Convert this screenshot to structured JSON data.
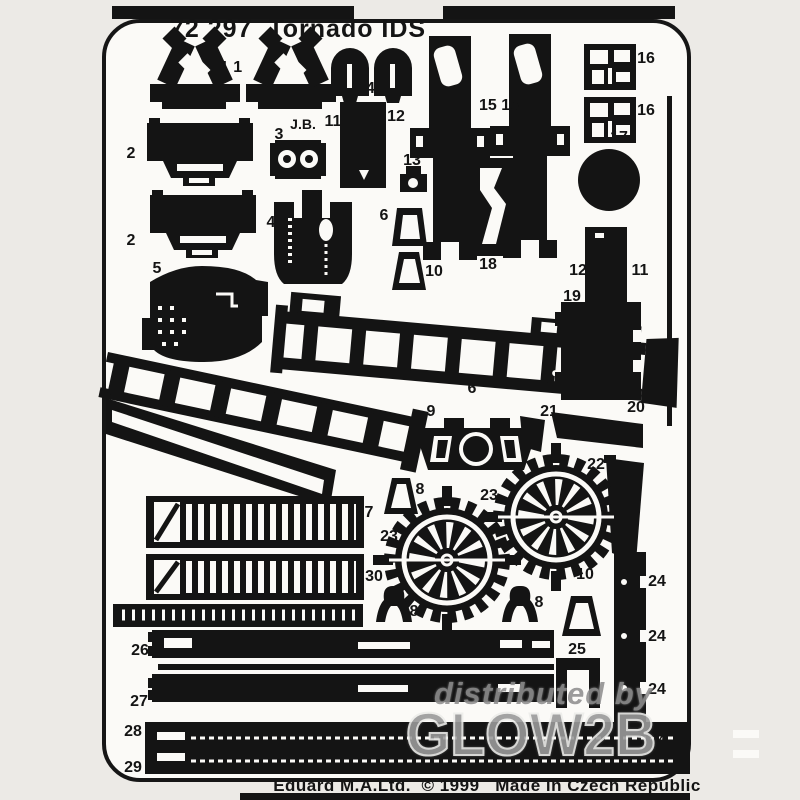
{
  "sheet": {
    "title": "72 297  Tornado IDS",
    "footer": "Eduard M.A.Ltd.  © 1999   Made in Czech Republic",
    "watermark": {
      "line1": "distributed by",
      "line2": "GLOW2B"
    }
  },
  "colors": {
    "bg": "#eceae6",
    "sheetc": "#fbfaf7",
    "ink": "#141414",
    "wm": "#8f8f8f"
  },
  "part_labels": [
    {
      "text": "1 1",
      "x": 231,
      "y": 68
    },
    {
      "text": "14",
      "x": 366,
      "y": 89
    },
    {
      "text": "15 15",
      "x": 499,
      "y": 106
    },
    {
      "text": "16",
      "x": 646,
      "y": 59
    },
    {
      "text": "16",
      "x": 646,
      "y": 111
    },
    {
      "text": "17",
      "x": 619,
      "y": 138
    },
    {
      "text": "J.B.",
      "x": 303,
      "y": 124,
      "size": 14
    },
    {
      "text": "3",
      "x": 279,
      "y": 135
    },
    {
      "text": "11",
      "x": 333,
      "y": 122
    },
    {
      "text": "12",
      "x": 396,
      "y": 117
    },
    {
      "text": "2",
      "x": 131,
      "y": 154
    },
    {
      "text": "13",
      "x": 412,
      "y": 161
    },
    {
      "text": "4",
      "x": 271,
      "y": 223
    },
    {
      "text": "6",
      "x": 384,
      "y": 216
    },
    {
      "text": "2",
      "x": 131,
      "y": 241
    },
    {
      "text": "5",
      "x": 157,
      "y": 269
    },
    {
      "text": "10",
      "x": 434,
      "y": 272
    },
    {
      "text": "18",
      "x": 488,
      "y": 265
    },
    {
      "text": "12",
      "x": 578,
      "y": 271
    },
    {
      "text": "11",
      "x": 640,
      "y": 271
    },
    {
      "text": "19",
      "x": 572,
      "y": 297
    },
    {
      "text": "6",
      "x": 472,
      "y": 389
    },
    {
      "text": "20",
      "x": 636,
      "y": 408
    },
    {
      "text": "9",
      "x": 431,
      "y": 412
    },
    {
      "text": "21",
      "x": 549,
      "y": 412
    },
    {
      "text": "22",
      "x": 596,
      "y": 465
    },
    {
      "text": "8",
      "x": 420,
      "y": 490
    },
    {
      "text": "23",
      "x": 489,
      "y": 496
    },
    {
      "text": "7",
      "x": 369,
      "y": 513
    },
    {
      "text": "23",
      "x": 389,
      "y": 537
    },
    {
      "text": "30",
      "x": 374,
      "y": 577
    },
    {
      "text": "10",
      "x": 585,
      "y": 575
    },
    {
      "text": "8",
      "x": 414,
      "y": 612
    },
    {
      "text": "8",
      "x": 539,
      "y": 603
    },
    {
      "text": "25",
      "x": 577,
      "y": 650
    },
    {
      "text": "24",
      "x": 657,
      "y": 582
    },
    {
      "text": "24",
      "x": 657,
      "y": 637
    },
    {
      "text": "24",
      "x": 657,
      "y": 690
    },
    {
      "text": "24",
      "x": 657,
      "y": 742
    },
    {
      "text": "26",
      "x": 140,
      "y": 651
    },
    {
      "text": "27",
      "x": 139,
      "y": 702
    },
    {
      "text": "28",
      "x": 133,
      "y": 732
    },
    {
      "text": "29",
      "x": 133,
      "y": 768
    }
  ]
}
